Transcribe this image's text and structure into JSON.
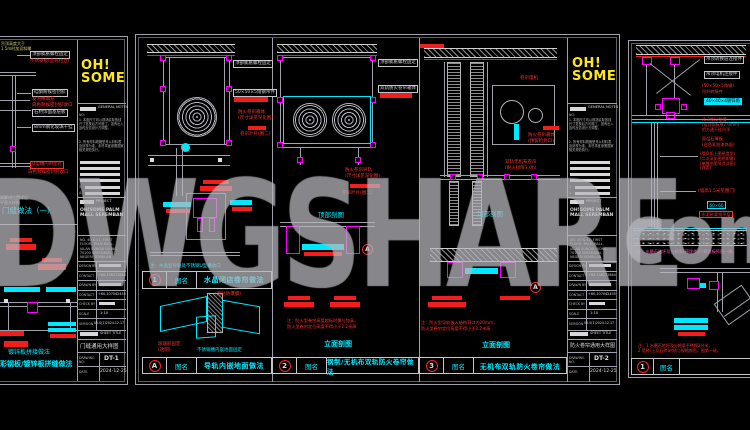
{
  "watermark": {
    "text": "DWGSHARE",
    "suffix": ".com"
  },
  "logo": {
    "top": "OH!",
    "bottom": "SOME"
  },
  "s1": {
    "top_note": [
      "吊顶高度大于",
      "1.5m时加设斜撑"
    ],
    "boxes": [
      "顶部膨胀螺栓固定",
      "硅酮耐候密封胶",
      "石材饰面基层板",
      "8mm钢化玻璃干挂"
    ],
    "red1": "不锈钢板(亚光拉丝)",
    "red2": [
      "发泡棒填充",
      "白色耐候密封胶收口"
    ],
    "red_box": "U型槽内衬垫片",
    "red3": "白色耐候密封胶收口",
    "side_note": [
      "踢脚线位置详见",
      "平面大样图"
    ],
    "caption_top": "门缝做法（一）",
    "caption_small": "镀锌板拼接做法",
    "caption_bottom": "彩钢板/镀锌板拼缝做法",
    "tb": {
      "general_notes": "GENERAL NOTES",
      "no_label": "NO:",
      "note1": "1. 本图尺寸均以现场实际放线尺寸复核后方可施工，如有出入及时反馈设计方调整。",
      "note2": "2. 所有材料规格型号以材料表及封样为准，未尽事宜参照国家相关规范执行。",
      "item3": "3.",
      "item4": "4.",
      "project_label": "PROJECT",
      "project_name": [
        "OH!SOME PALM",
        "MALL SEREMBAN"
      ],
      "address": [
        "NO. 40 & 41, FIRST",
        "FLOOR, PALM MALL,",
        "JALAN SUNGAI UJONG,",
        "70200 SEREMBAN,",
        "NEGERI SEMBILAN"
      ],
      "fields": [
        {
          "label": "DESIGN BY",
          "value": ""
        },
        {
          "label": "CONTACT",
          "value": "+60-138372844"
        },
        {
          "label": "DRAWN BY",
          "value": ""
        },
        {
          "label": "CONTACT",
          "value": "+60-107042455"
        },
        {
          "label": "CHECK BY",
          "value": ""
        },
        {
          "label": "SCALE",
          "value": "1:10"
        },
        {
          "label": "VERSION",
          "value": "V5.0(1)2024.12.17"
        }
      ],
      "sheet_title_label": "SHEET TITLE",
      "sheet_title": "门缝通用大样图",
      "drawing_no_label": "DRAWING NO:",
      "drawing_no": "DT-1",
      "date_label": "DATE:",
      "date": "2024-12-25"
    }
  },
  "s2": {
    "col1": {
      "box1": "顶部膨胀螺栓固定",
      "box2": "50×50×5角钢吊件",
      "red1": [
        "防火卷帘箱体",
        "(尺寸详见深化图)"
      ],
      "red2": "卷帘叶片(图二)",
      "note": "注：水晶型导轨处不锈钢U型槽收口",
      "strip": {
        "num": "1",
        "label": "图名",
        "name": "水晶闭店卷帘做法"
      },
      "a_red1": [
        "不锈钢导轨",
        "(面贴防爆膜)"
      ],
      "a_red2": [
        "玻璃胶固定",
        "(透明)"
      ],
      "a_cyan": "不锈钢槽内嵌地面固定",
      "stripA": {
        "num": "A",
        "label": "图名",
        "name": "导轨内嵌地面做法"
      }
    },
    "col2": {
      "box1": "顶部膨胀螺栓固定",
      "box2": "双轨防火卷帘箱体",
      "red1": [
        "防火卷帘导轨",
        "(尺寸详见深化图)"
      ],
      "red2": "卷帘叶片(图二)",
      "plan": "顶部剖图",
      "ref": "A",
      "note": [
        "注：防火型卷帘高度超标时需与加高，",
        "防火型卷帘定位高度不得小于2.2米高"
      ],
      "elev": "立面剖图",
      "strip": {
        "num": "2",
        "label": "图名",
        "name": "钢制/无机布双轨防火卷帘做法"
      }
    },
    "col3": {
      "red1": "卷帘电机",
      "red2": [
        "防火卷帘箱体",
        "(预留检修口)"
      ],
      "red3": [
        "双轨无机布卷帘",
        "(耐火极限3.0h)"
      ],
      "plan": "顶部剖图",
      "ref": "A",
      "note": [
        "注：防火型导轨嵌入结构洞口内20mm，",
        "防火型卷帘定位高度不得小于2.2米高"
      ],
      "elev": "立面剖图",
      "strip": {
        "num": "3",
        "label": "图名",
        "name": "无机布双轨防火卷帘做法"
      }
    },
    "tb": {
      "general_notes": "GENERAL NOTES",
      "no_label": "NO:",
      "note1": "1. 本图尺寸均以现场实际放线尺寸复核后方可施工，如有出入及时反馈设计方调整。",
      "note2": "2. 所有材料规格型号以材料表及封样为准，未尽事宜参照国家相关规范执行。",
      "item3": "3.",
      "item4": "4.",
      "project_label": "PROJECT",
      "project_name": [
        "OH!SOME PALM",
        "MALL SEREMBAN"
      ],
      "address": [
        "NO. 40 & 41, FIRST",
        "FLOOR, PALM MALL,",
        "JALAN SUNGAI UJONG,",
        "70200 SEREMBAN,",
        "NEGERI SEMBILAN"
      ],
      "fields": [
        {
          "label": "DESIGN BY",
          "value": ""
        },
        {
          "label": "CONTACT",
          "value": "+60-138372844"
        },
        {
          "label": "DRAWN BY",
          "value": ""
        },
        {
          "label": "CONTACT",
          "value": "+60-107042455"
        },
        {
          "label": "CHECK BY",
          "value": ""
        },
        {
          "label": "SCALE",
          "value": "1:10"
        },
        {
          "label": "VERSION",
          "value": "V5.0(1)2024.12.17"
        }
      ],
      "sheet_title_label": "SHEET TITLE",
      "sheet_title": "防火卷帘通用大样图",
      "drawing_no_label": "DRAWING NO:",
      "drawing_no": "DT-2",
      "date_label": "DATE:",
      "date": "2024-12-25"
    }
  },
  "s3": {
    "box1": "吊顶转换层连接件",
    "box2": "吊顶电机连接件",
    "red1": [
      "(50×50×5角钢)",
      "吊杆转接件"
    ],
    "cyan_hl": "40×40×4镀锌角钢",
    "red2": [
      "(1.2厚)U型槽",
      "(镀锌钢板厚2.0mm)",
      "铝方通干挂吊顶"
    ],
    "red3": [
      "面层石膏板",
      "(白色乳胶漆饰面)"
    ],
    "red4": [
      "(墙身如上图纸造型)",
      "(二次深化图纸如需)",
      "(单独出图节点详图)",
      "(饰面)"
    ],
    "red5": "(墙高1.5米见图门)",
    "cyan_box": "60×60",
    "red_box": "水泥砂浆找平层",
    "note1": "注：水磨石地坪及分格条(预埋件)与预埋板预图一致。",
    "note2": [
      "注：1.水磨石地坪及分格条不锈钢2分米。",
      "2.墙砖(上及石砖)材质与规格颜色，图第一致。"
    ],
    "strip": {
      "num": "1",
      "label": "图名",
      "name": ""
    }
  }
}
